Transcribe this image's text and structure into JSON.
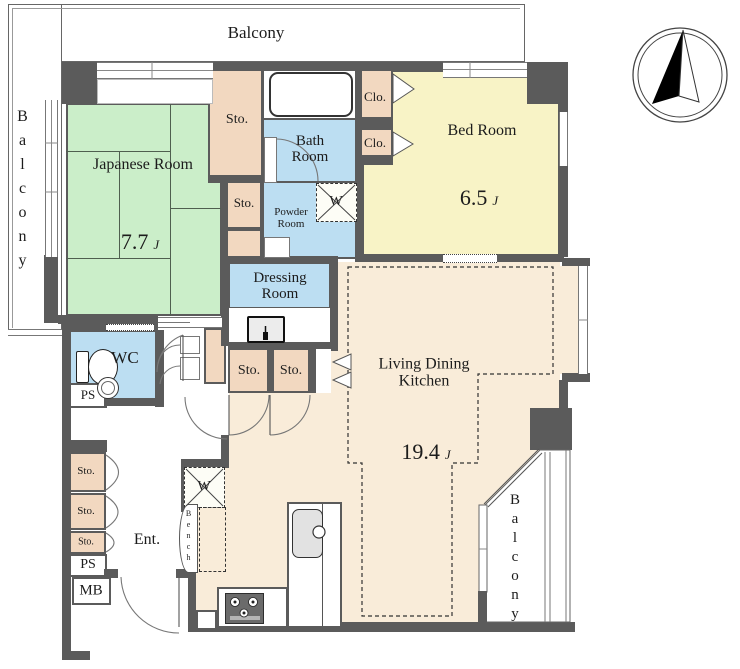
{
  "labels": {
    "balcony": "Balcony",
    "japanese_room": "Japanese Room",
    "japanese_room_size": "7.7",
    "bed_room": "Bed Room",
    "bed_room_size": "6.5",
    "ldk_line1": "Living Dining",
    "ldk_line2": "Kitchen",
    "ldk_size": "19.4",
    "size_unit": "J",
    "bath_line1": "Bath",
    "bath_line2": "Room",
    "powder_line1": "Powder",
    "powder_line2": "Room",
    "dressing_line1": "Dressing",
    "dressing_line2": "Room",
    "wc": "WC",
    "ent": "Ent.",
    "bench": "Bench",
    "storage": "Sto.",
    "closet": "Clo.",
    "pipe_space": "PS",
    "meter_box": "MB",
    "washer": "W"
  },
  "colors": {
    "wall": "#5b5b5b",
    "tatami_green": "#cbeec9",
    "storage_tan": "#f2d8c0",
    "wet_area_blue": "#bcdef2",
    "bedroom_yellow": "#f8f3c6",
    "ldk_beige": "#f9ecd9",
    "text": "#1c1c1c"
  }
}
